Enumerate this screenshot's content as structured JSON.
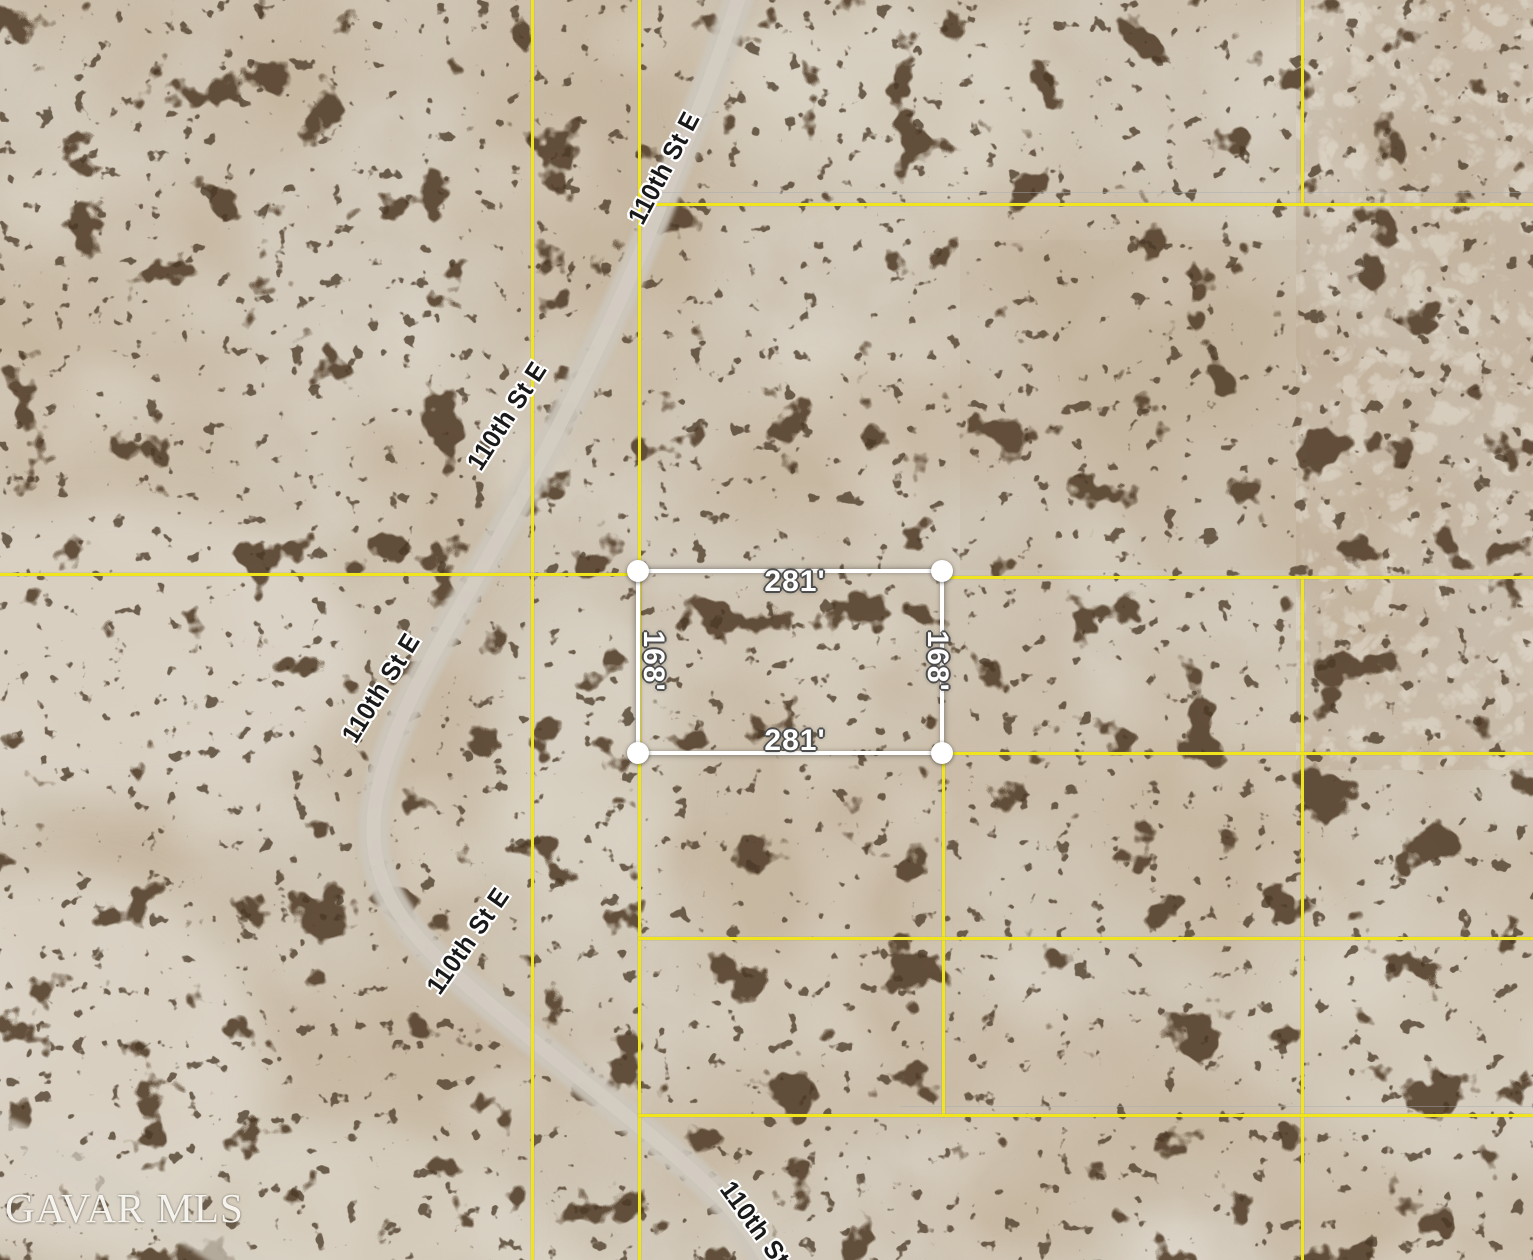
{
  "watermark": {
    "text": "GAVAR MLS"
  },
  "road": {
    "label": "110th St E"
  },
  "parcel": {
    "top_dimension": "281'",
    "bottom_dimension": "281'",
    "left_dimension": "168'",
    "right_dimension": "168'"
  },
  "colors": {
    "boundary_yellow": "#efe41d",
    "parcel_outline_white": "#ffffff",
    "corner_marker_white": "#ffffff",
    "dimension_text": "#ffffff",
    "dimension_halo": "#4d4d4d",
    "road_label_text": "#191919",
    "road_label_halo": "#ffffff",
    "terrain_base": "#d2c9ba",
    "shrub_dark": "#57432e",
    "watermark_text": "#faf8f2"
  }
}
